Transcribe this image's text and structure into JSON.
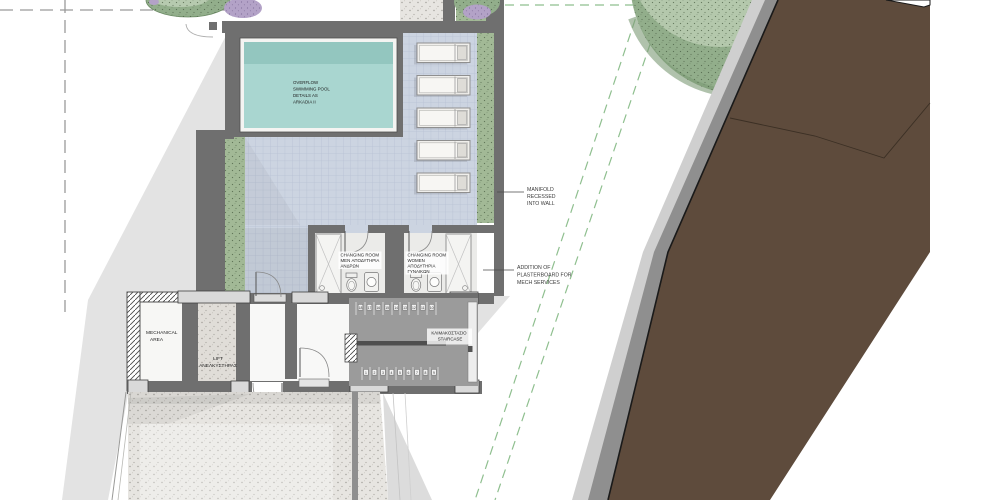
{
  "colors": {
    "wall": "#6f6f6f",
    "water": "#a9d6d0",
    "water_shadow": "#93c6bf",
    "pool_coping": "#f4f4f2",
    "deck_tile": "#ccd4e1",
    "planter_green": "#a2b996",
    "tree_green": "#92ae8b",
    "tree_light": "#bacdb2",
    "flower_purple": "#b3a2c7",
    "terrain_brown": "#5e4b3c",
    "stair_grey": "#9b9b9b",
    "floor_concrete": "#e7e5e1",
    "shadow_grey": "#e3e3e3",
    "guide_green": "#8fbf8f",
    "guide_grey": "#9a9a9a"
  },
  "pool": {
    "label": [
      "OVERFLOW",
      "SWIMMING POOL",
      "DETAILS AS",
      "ARKADIA II"
    ]
  },
  "annotations": {
    "manifold": [
      "MANIFOLD",
      "RECESSED",
      "INTO WALL"
    ],
    "plasterboard": [
      "ADDITION OF",
      "PLASTERBOARD FOR",
      "MECH SERVICES"
    ]
  },
  "rooms": {
    "changing_men": [
      "CHANGING ROOM",
      "MEN ΑΠΟΔΥΤΗΡΙΑ",
      "ΑΝΔΡΩΝ"
    ],
    "changing_women": [
      "CHANGING ROOM",
      "WOMEN",
      "ΑΠΟΔΥΤΗΡΙΑ",
      "ΓΥΝΑΙΚΩΝ"
    ],
    "mechanical": [
      "MECHANICAL",
      "AREA"
    ],
    "lift": [
      "LIFT",
      "ΑΝΕΛΚΥΣΤΗΡΑΣ"
    ],
    "staircase": [
      "ΚΛΙΜΑΚΟΣΤΑΣΙΟ",
      "STAIRCASE"
    ]
  },
  "stairs": {
    "top_numbers": [
      "18",
      "17",
      "16",
      "15",
      "14",
      "13",
      "12",
      "11",
      "10"
    ],
    "bottom_numbers": [
      "1",
      "2",
      "3",
      "4",
      "5",
      "6",
      "7",
      "8",
      "9"
    ]
  }
}
